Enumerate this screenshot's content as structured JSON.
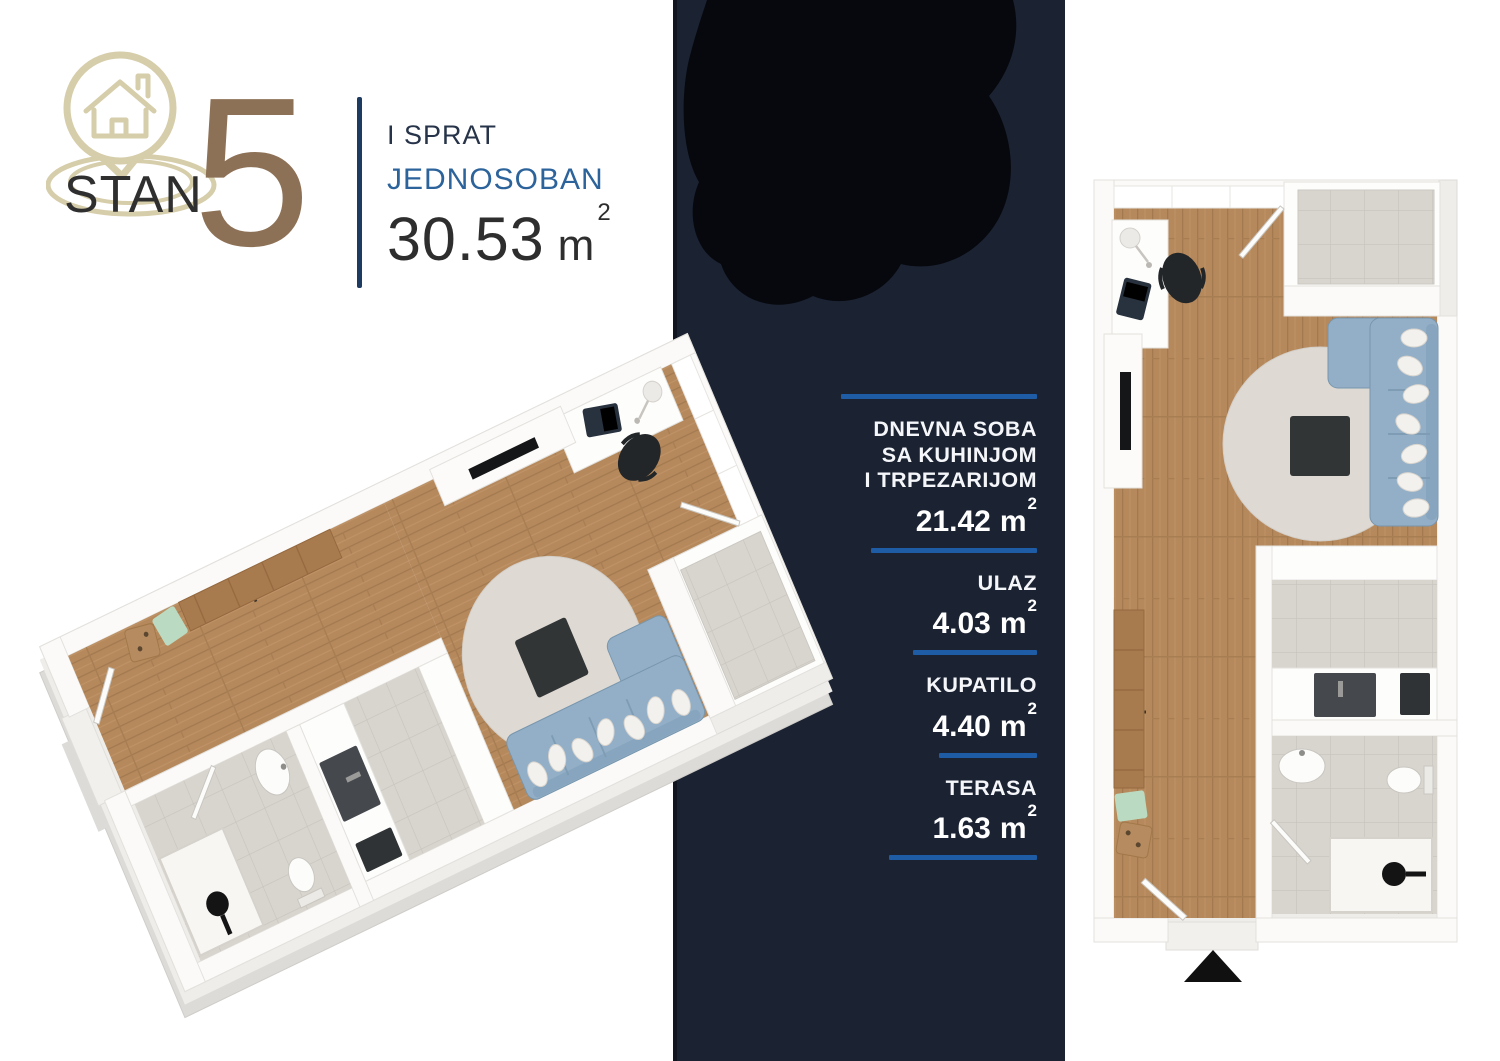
{
  "header": {
    "brand_name": "STAN",
    "unit_number": "5",
    "floor_label": "I SPRAT",
    "unit_type": "JEDNOSOBAN",
    "total_area": {
      "value": "30.53",
      "unit": "m",
      "sup": "2"
    }
  },
  "room_list": {
    "items": [
      {
        "name_lines": [
          "DNEVNA SOBA",
          "SA KUHINJOM",
          "I TRPEZARIJOM"
        ],
        "area": {
          "value": "21.42",
          "unit": "m",
          "sup": "2"
        }
      },
      {
        "name_lines": [
          "ULAZ"
        ],
        "area": {
          "value": "4.03",
          "unit": "m",
          "sup": "2"
        }
      },
      {
        "name_lines": [
          "KUPATILO"
        ],
        "area": {
          "value": "4.40",
          "unit": "m",
          "sup": "2"
        }
      },
      {
        "name_lines": [
          "TERASA"
        ],
        "area": {
          "value": "1.63",
          "unit": "m",
          "sup": "2"
        }
      }
    ]
  },
  "icons": {
    "logo": "house-pin-icon",
    "entrance_marker": "up-triangle-icon"
  },
  "colors": {
    "band_navy": "#1b2232",
    "rule_blue": "#1e5ca6",
    "accent_blue": "#2c639b",
    "dark_navy": "#1d3a60",
    "number_brown": "#8d7156",
    "logo_tan": "#d6cdaa",
    "ink": "#2e2e2e",
    "wood": "#b6895c",
    "tile_gray": "#d8d5ce",
    "sofa_blue": "#93afc7",
    "rug": "#ded9d3"
  }
}
